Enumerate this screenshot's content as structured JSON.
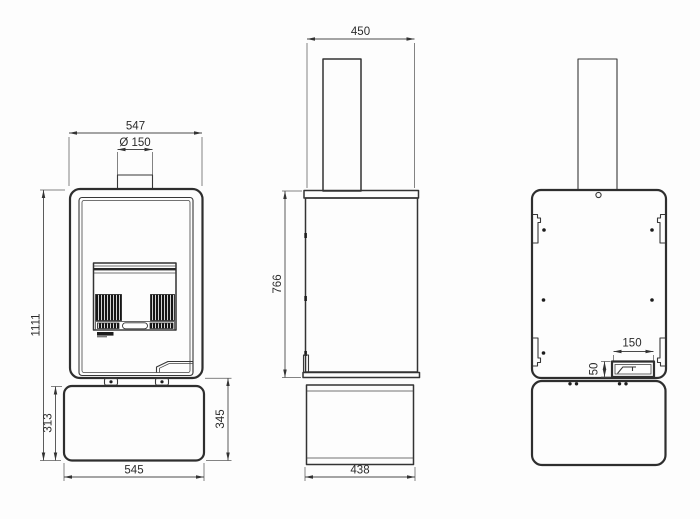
{
  "meta": {
    "drawing_type": "stove-three-view-dimensional-drawing",
    "units": "mm",
    "colors": {
      "line": "#333333",
      "heavy_line": "#2e2e2e",
      "background": "#fdfdfd",
      "dark_fill": "#1c1c1c"
    }
  },
  "views": {
    "front": {
      "dims": {
        "width": "547",
        "flue_diameter": "Ø 150",
        "total_height": "1111",
        "pedestal_height": "313",
        "lower_section_height": "345",
        "pedestal_width": "545"
      }
    },
    "side": {
      "dims": {
        "depth": "450",
        "body_height": "766",
        "pedestal_depth": "438"
      }
    },
    "back": {
      "dims": {
        "air_inlet_width": "150",
        "air_inlet_height": "50"
      }
    }
  }
}
